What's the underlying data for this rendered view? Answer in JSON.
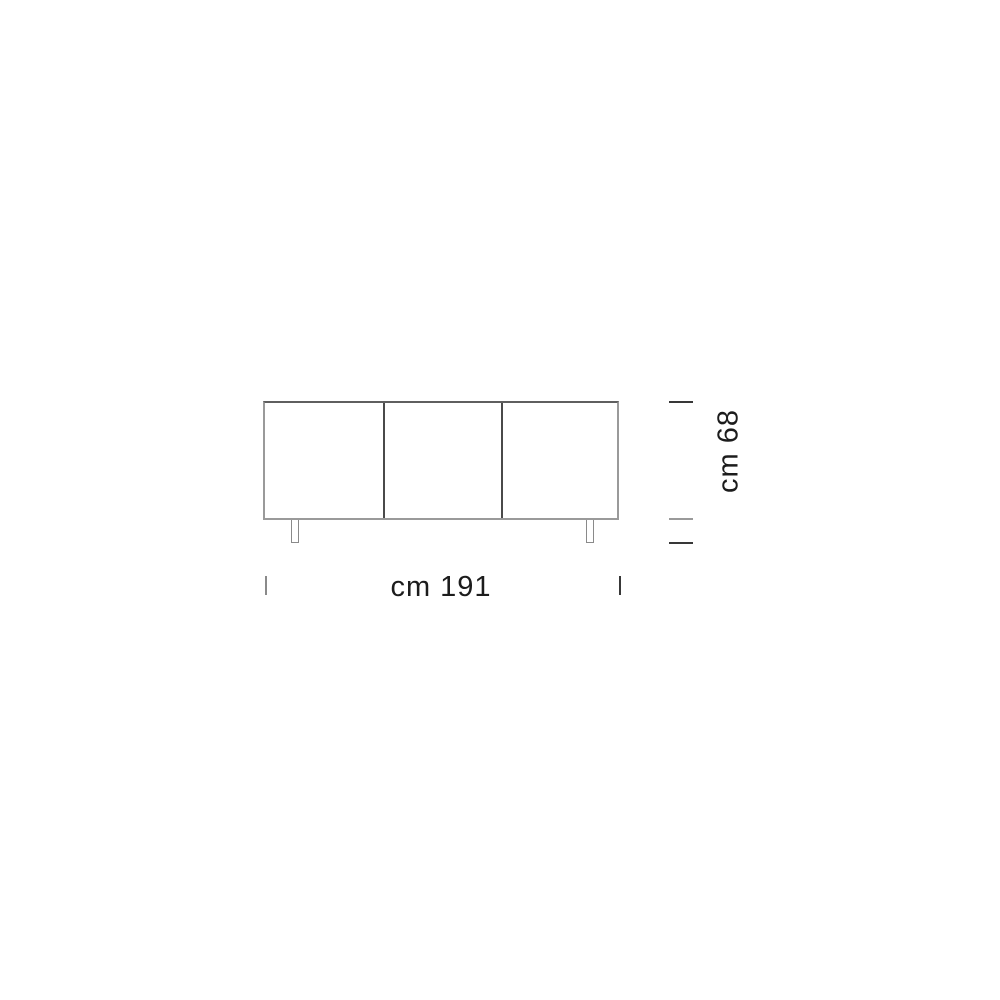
{
  "diagram": {
    "type": "furniture-dimension-drawing",
    "subject": "three-door sideboard, front elevation",
    "door_count": 3,
    "leg_count": 2
  },
  "dimensions": {
    "width_label": "cm 191",
    "height_label": "cm 68",
    "width_cm": 191,
    "height_cm": 68
  },
  "colors": {
    "background": "#ffffff",
    "outline": "#9a9a9a",
    "outline_top": "#5f5f5f",
    "door_divider": "#4a4a4a",
    "tick_dark": "#383838",
    "tick_light": "#9a9a9a",
    "text": "#1c1c1c"
  }
}
